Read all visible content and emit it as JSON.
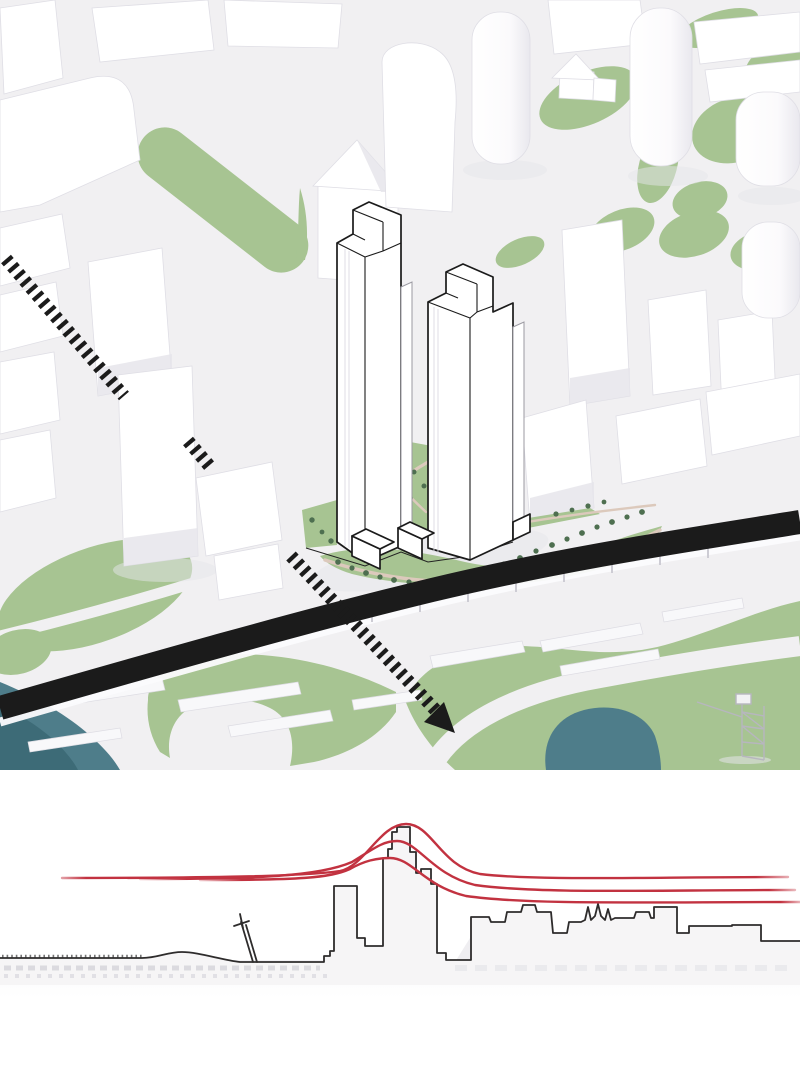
{
  "figure": {
    "panels": [
      {
        "name": "axonometric-site-plan"
      },
      {
        "name": "skyline-height-diagram"
      }
    ]
  },
  "colors": {
    "canvas_bg": "#f1f0f2",
    "building_white": "#ffffff",
    "building_shade": "#e6e5eb",
    "building_edge": "#dfdee5",
    "ghost_fill": "#f8f8fa",
    "ghost_edge": "#dddce3",
    "green": "#a7c492",
    "tree": "#4e6f50",
    "path_tan": "#dcc9bc",
    "ink_black": "#1b1b1b",
    "water_teal": "#4e7d8a",
    "water_teal_dark": "#3d6b77",
    "detail_gray": "#9b9aa2",
    "red_line": "#c23240",
    "skyline_stroke": "#2e2c2c",
    "skyline_fill": "#f6f5f6",
    "skyline_ghost": "#ebeaee",
    "ground_shade": "#e6e5ea"
  },
  "skyline_diagram": {
    "red_contour_lines": {
      "count": 3,
      "peaks_x": [
        406,
        397,
        390
      ],
      "peaks_y": [
        824,
        841,
        858
      ],
      "left_baseline_y": 878,
      "right_baseline_y": [
        877,
        890,
        902
      ]
    }
  }
}
